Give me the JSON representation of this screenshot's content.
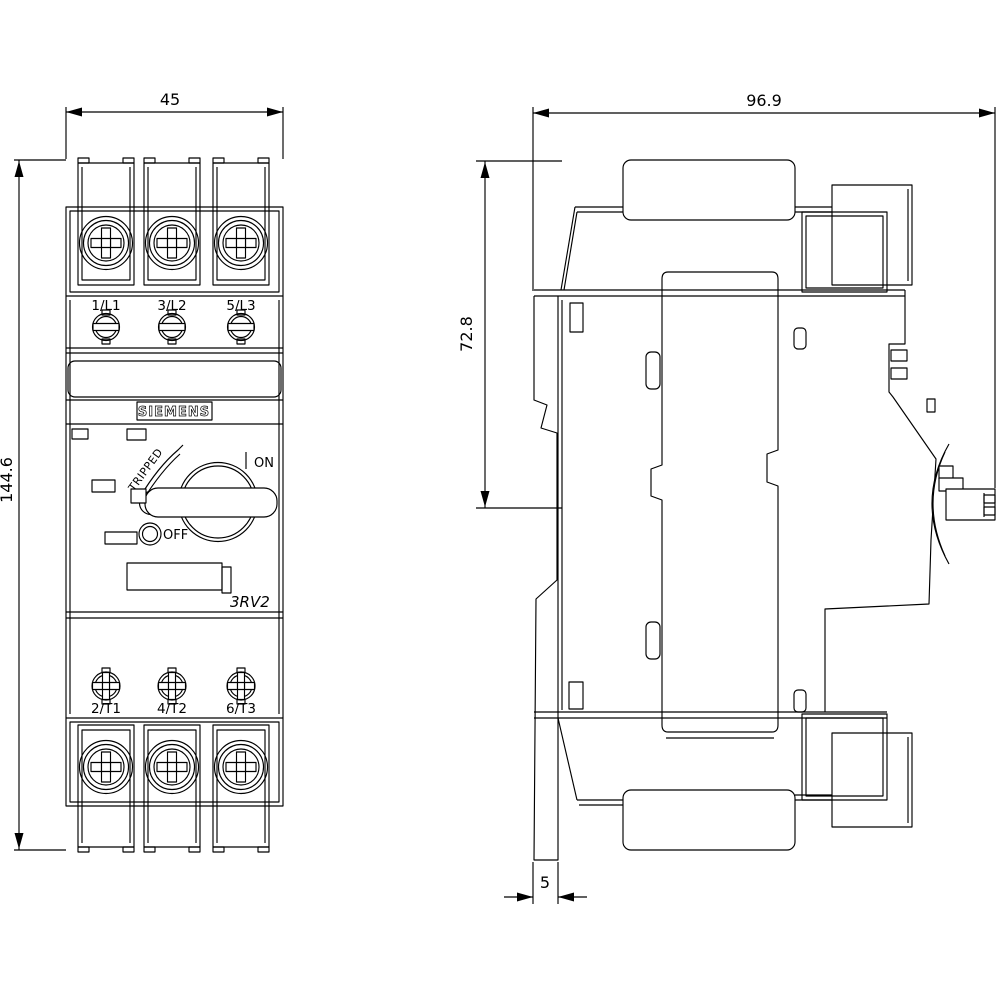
{
  "front_view": {
    "dimensions": {
      "width": "45",
      "height": "144.6"
    },
    "brand": "SIEMENS",
    "model": "3RV2",
    "controls": {
      "tripped": "TRIPPED",
      "on": "ON",
      "off": "OFF"
    },
    "top_terminals": [
      "1/L1",
      "3/L2",
      "5/L3"
    ],
    "bottom_terminals": [
      "2/T1",
      "4/T2",
      "6/T3"
    ]
  },
  "side_view": {
    "dimensions": {
      "depth": "96.9",
      "upper_depth": "72.8",
      "rail_plate": "5"
    }
  },
  "colors": {
    "line": "#000000",
    "background": "#ffffff"
  }
}
